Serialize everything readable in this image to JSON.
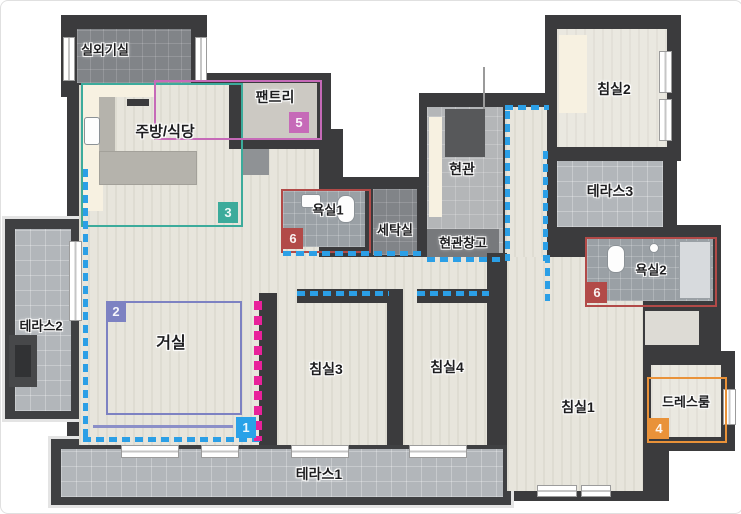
{
  "rooms": {
    "outdoor_unit": {
      "label": "실외기실"
    },
    "kitchen": {
      "label": "주방/식당"
    },
    "pantry": {
      "label": "팬트리"
    },
    "bath1": {
      "label": "욕실1"
    },
    "laundry": {
      "label": "세탁실"
    },
    "entrance": {
      "label": "현관"
    },
    "entrance_storage": {
      "label": "현관창고"
    },
    "bedroom2": {
      "label": "침실2"
    },
    "terrace3": {
      "label": "테라스3"
    },
    "bath2": {
      "label": "욕실2"
    },
    "terrace2": {
      "label": "테라스2"
    },
    "living": {
      "label": "거실"
    },
    "bedroom3": {
      "label": "침실3"
    },
    "bedroom4": {
      "label": "침실4"
    },
    "bedroom1": {
      "label": "침실1"
    },
    "dressroom": {
      "label": "드레스룸"
    },
    "terrace1": {
      "label": "테라스1"
    }
  },
  "zones": {
    "zone1": {
      "number": "1",
      "color": "#2aa2e8"
    },
    "zone2": {
      "number": "2",
      "color": "#7d82c2"
    },
    "zone3": {
      "number": "3",
      "color": "#3cab9b"
    },
    "zone4": {
      "number": "4",
      "color": "#e99239"
    },
    "zone5": {
      "number": "5",
      "color": "#c66ab8"
    },
    "zone6a": {
      "number": "6",
      "color": "#b24a48"
    },
    "zone6b": {
      "number": "6",
      "color": "#b24a48"
    }
  },
  "colors": {
    "wall": "#3b3b3d",
    "wood_floor": "#e7e5dc",
    "terrace_tile": "#b2b6ba",
    "bath_tile": "#9aa0a5",
    "blue_dash": "#2b9fe6",
    "pink_dash": "#e8219a",
    "teal_zone": "#3cab9b",
    "magenta_zone": "#c66ab8",
    "red_zone": "#b24a48",
    "purple_zone": "#7d82c2",
    "orange_zone": "#e99239",
    "blue_zone": "#2aa2e8"
  }
}
